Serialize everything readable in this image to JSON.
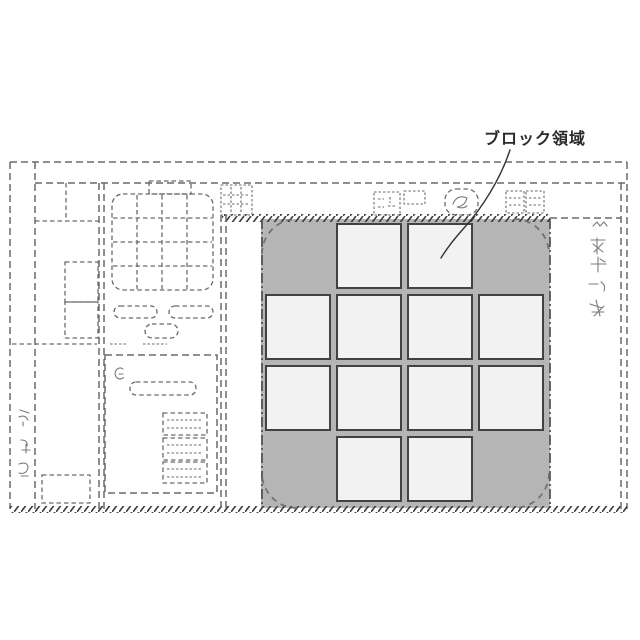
{
  "figure": {
    "label": "ブロック領域"
  },
  "block_region": {
    "label": "ブロック領域",
    "grid": {
      "rows": 4,
      "cols": 4,
      "occupied_cells": [
        [
          0,
          1
        ],
        [
          0,
          2
        ],
        [
          1,
          0
        ],
        [
          1,
          1
        ],
        [
          1,
          2
        ],
        [
          1,
          3
        ],
        [
          2,
          0
        ],
        [
          2,
          1
        ],
        [
          2,
          2
        ],
        [
          2,
          3
        ],
        [
          3,
          1
        ],
        [
          3,
          2
        ]
      ]
    }
  },
  "annotations": {
    "right_margin_scribble_count": 5,
    "left_margin_scribble_count": 3
  },
  "colors": {
    "region_fill": "#b5b5b5",
    "cell_fill": "#f2f2f2",
    "cell_border": "#424242",
    "dashed_line": "#6a6a6a",
    "label_text": "#2a2a2a"
  }
}
